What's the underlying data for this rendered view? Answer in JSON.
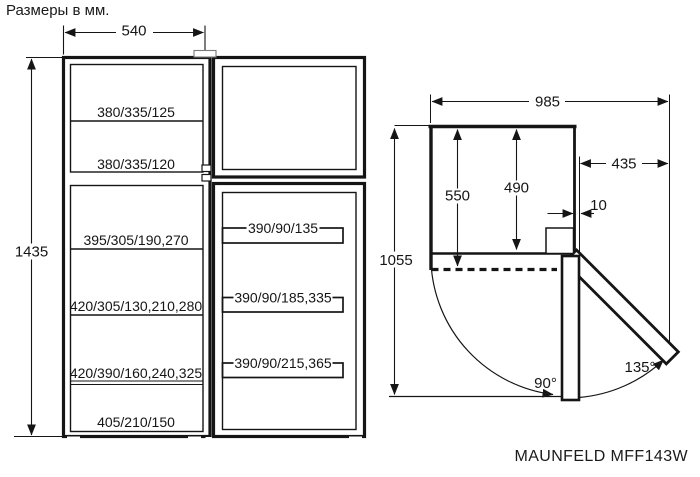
{
  "title": "Размеры в мм.",
  "model": "MAUNFELD MFF143W",
  "front_view": {
    "width": "540",
    "height": "1435",
    "freezer_shelves": [
      "380/335/125",
      "380/335/120"
    ],
    "fridge_shelves": [
      "395/305/190,270",
      "420/305/130,210,280",
      "420/390/160,240,325",
      "405/210/150"
    ],
    "door_shelves": [
      "390/90/135",
      "390/90/185,335",
      "390/90/215,365"
    ]
  },
  "top_view": {
    "total_width_door_open": "985",
    "door_swing_clearance": "435",
    "depth_with_door": "550",
    "depth_without_door": "490",
    "door_protrusion": "10",
    "total_depth_door_open": "1055",
    "door_angle_90": "90°",
    "door_angle_135": "135°"
  }
}
